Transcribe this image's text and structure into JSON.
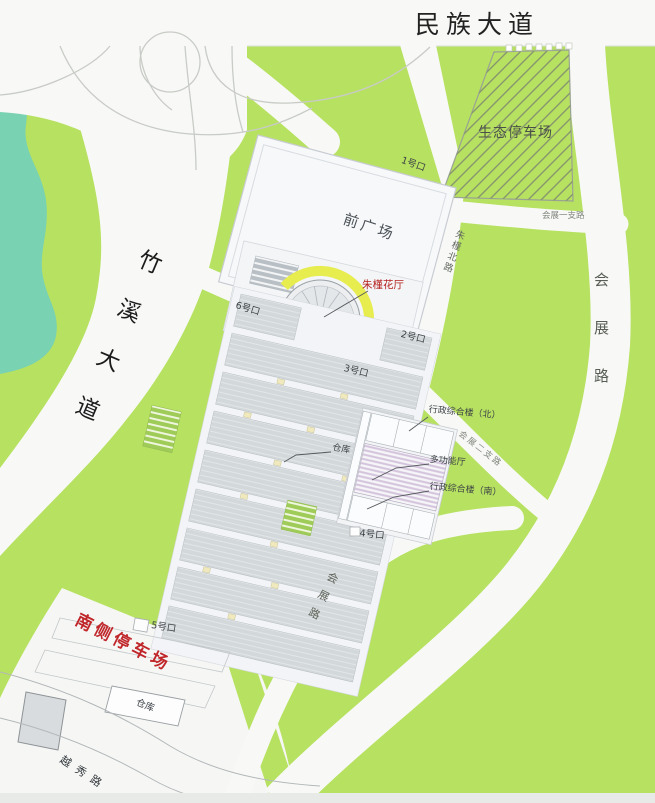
{
  "map": {
    "roads": {
      "minzu_avenue": "民族大道",
      "zhuxi_avenue": "竹溪大道",
      "huizhan_road": "会展路",
      "huizhan_branch_1": "会展一支路",
      "huizhan_branch_2": "会展二支路",
      "zhujin_north_road": "朱槿北路",
      "yuexiu_road": "越秀路"
    },
    "places": {
      "eco_parking": "生态停车场",
      "front_plaza": "前广场",
      "flower_hall": "朱槿花厅",
      "warehouse_north": "仓库",
      "warehouse_south": "仓库",
      "admin_building_north": "行政综合楼（北）",
      "multifunction_hall": "多功能厅",
      "admin_building_south": "行政综合楼（南）",
      "south_parking": "南侧停车场"
    },
    "gates": {
      "g1": "1号口",
      "g2": "2号口",
      "g3": "3号口",
      "g4": "4号口",
      "g5": "5号口",
      "g6": "6号口"
    },
    "colors": {
      "map_green": "#b7e161",
      "river_teal": "#79d2b2",
      "road_white": "#f8f9f7",
      "hall_gray": "#d3d8da",
      "flower_hall_arc_yellow": "#e7ec4f",
      "label_red": "#b5231f",
      "multifunction_stripe_pink": "#d3c3dc"
    }
  }
}
